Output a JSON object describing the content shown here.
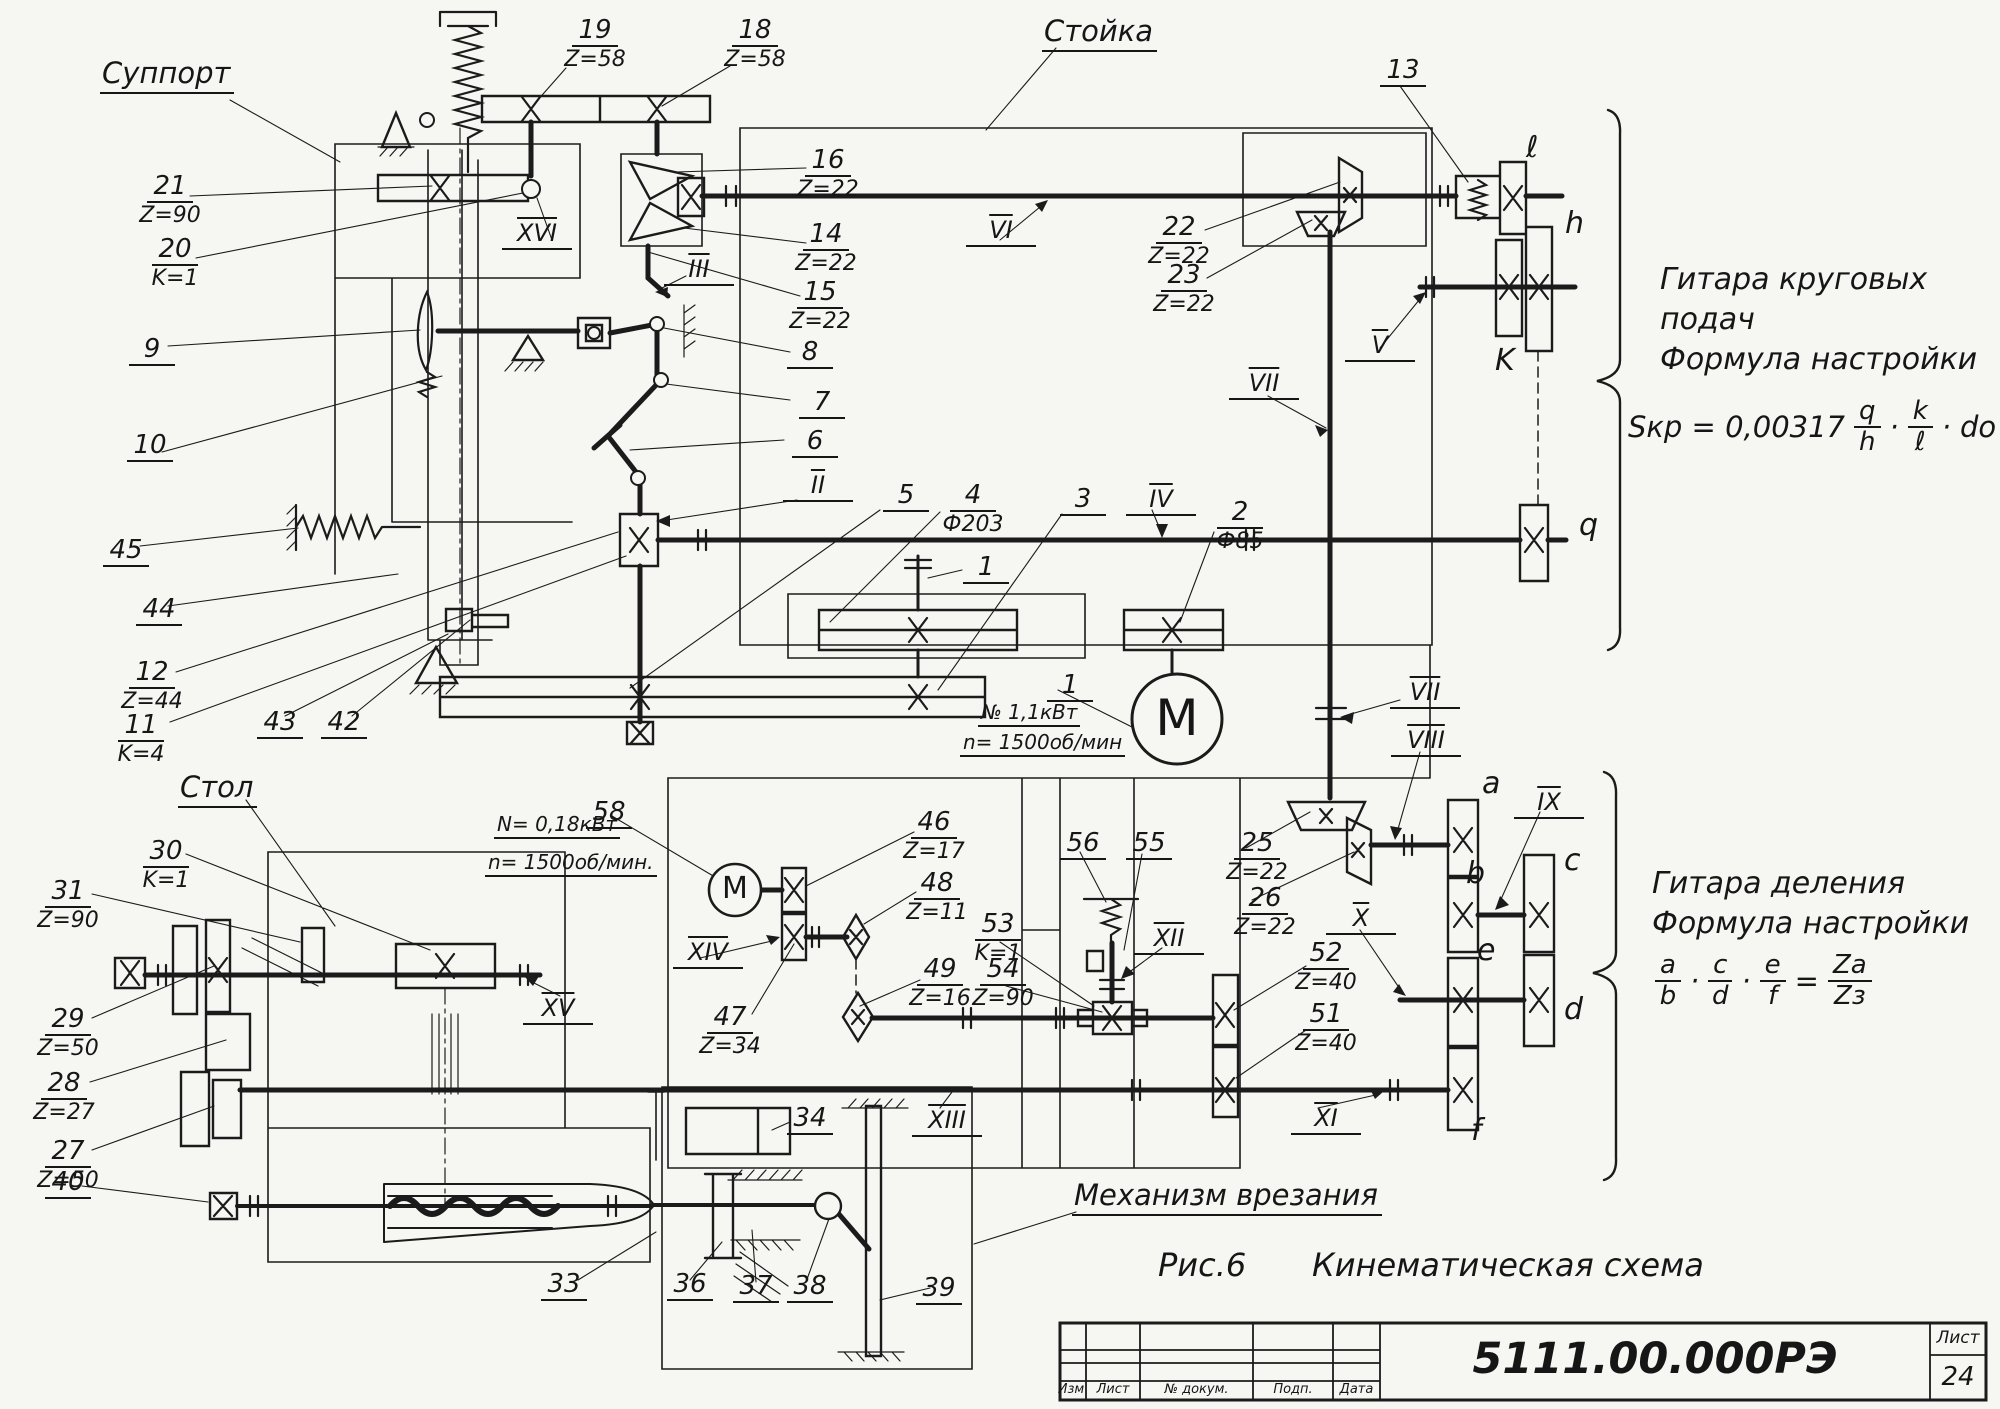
{
  "page": {
    "figure_label": "Рис.6",
    "figure_title": "Кинематическая схема"
  },
  "titles": {
    "support": "Суппорт",
    "stand": "Стойка",
    "table": "Стол",
    "mechanism": "Механизм врезания"
  },
  "notes": {
    "circular": {
      "line1": "Гитара круговых",
      "line2": "подач",
      "line3": "Формула настройки"
    },
    "circular_formula": {
      "lead": "Sкр = 0,00317",
      "n1": "q",
      "d1": "h",
      "dot1": "·",
      "n2": "k",
      "d2": "ℓ",
      "dot2": "·",
      "tail": "do"
    },
    "division": {
      "line1": "Гитара деления",
      "line2": "Формула настройки"
    },
    "division_formula": {
      "n1": "a",
      "d1": "b",
      "dot1": "·",
      "n2": "c",
      "d2": "d",
      "dot2": "·",
      "n3": "e",
      "d3": "f",
      "eq": "=",
      "rn": "Za",
      "rd": "Zз"
    }
  },
  "motors": {
    "main": {
      "symbol": "М",
      "power": "№ 1,1кВт",
      "speed": "n= 1500об/мин"
    },
    "aux": {
      "symbol": "М",
      "power": "N= 0,18кВт",
      "speed": "n= 1500об/мин."
    }
  },
  "callouts": {
    "c1a": {
      "num": "1"
    },
    "c1b": {
      "num": "1"
    },
    "c2": {
      "num": "2",
      "val": "Ф85"
    },
    "c3": {
      "num": "3"
    },
    "c4": {
      "num": "4",
      "val": "Ф203"
    },
    "c5": {
      "num": "5"
    },
    "c6": {
      "num": "6"
    },
    "c7": {
      "num": "7"
    },
    "c8": {
      "num": "8"
    },
    "c9": {
      "num": "9"
    },
    "c10": {
      "num": "10"
    },
    "c11": {
      "num": "11",
      "val": "K=4"
    },
    "c12": {
      "num": "12",
      "val": "Z=44"
    },
    "c13": {
      "num": "13"
    },
    "c14": {
      "num": "14",
      "val": "Z=22"
    },
    "c15": {
      "num": "15",
      "val": "Z=22"
    },
    "c16": {
      "num": "16",
      "val": "Z=22"
    },
    "c18": {
      "num": "18",
      "val": "Z=58"
    },
    "c19": {
      "num": "19",
      "val": "Z=58"
    },
    "c20": {
      "num": "20",
      "val": "K=1"
    },
    "c21": {
      "num": "21",
      "val": "Z=90"
    },
    "c22": {
      "num": "22",
      "val": "Z=22"
    },
    "c23": {
      "num": "23",
      "val": "Z=22"
    },
    "c25": {
      "num": "25",
      "val": "Z=22"
    },
    "c26": {
      "num": "26",
      "val": "Z=22"
    },
    "c27": {
      "num": "27",
      "val": "Z=50"
    },
    "c28": {
      "num": "28",
      "val": "Z=27"
    },
    "c29": {
      "num": "29",
      "val": "Z=50"
    },
    "c30": {
      "num": "30",
      "val": "K=1"
    },
    "c31": {
      "num": "31",
      "val": "Z=90"
    },
    "c33": {
      "num": "33"
    },
    "c34": {
      "num": "34"
    },
    "c36": {
      "num": "36"
    },
    "c37": {
      "num": "37"
    },
    "c38": {
      "num": "38"
    },
    "c39": {
      "num": "39"
    },
    "c40": {
      "num": "40"
    },
    "c42": {
      "num": "42"
    },
    "c43": {
      "num": "43"
    },
    "c44": {
      "num": "44"
    },
    "c45": {
      "num": "45"
    },
    "c46": {
      "num": "46",
      "val": "Z=17"
    },
    "c47": {
      "num": "47",
      "val": "Z=34"
    },
    "c48": {
      "num": "48",
      "val": "Z=11"
    },
    "c49": {
      "num": "49",
      "val": "Z=16"
    },
    "c51": {
      "num": "51",
      "val": "Z=40"
    },
    "c52": {
      "num": "52",
      "val": "Z=40"
    },
    "c53": {
      "num": "53",
      "val": "K=1"
    },
    "c54": {
      "num": "54",
      "val": "Z=90"
    },
    "c55": {
      "num": "55"
    },
    "c56": {
      "num": "56"
    },
    "c58": {
      "num": "58"
    }
  },
  "shafts": {
    "s2": "II",
    "s3": "III",
    "s4": "IV",
    "s5": "V",
    "s6": "VI",
    "s7a": "VII",
    "s7b": "VII",
    "s8": "VIII",
    "s9": "IX",
    "s10": "X",
    "s11": "XI",
    "s12": "XII",
    "s13": "XIII",
    "s14": "XIV",
    "s15": "XV",
    "s16": "XVI"
  },
  "letters": {
    "l": "ℓ",
    "h": "h",
    "k": "K",
    "q": "q",
    "a": "a",
    "b": "b",
    "c": "c",
    "d": "d",
    "e": "e",
    "f": "f"
  },
  "title_block": {
    "doc_number": "5111.00.000РЭ",
    "sheet_label": "Лист",
    "sheet_number": "24",
    "columns": [
      "Изм",
      "Лист",
      "№ докум.",
      "Подп.",
      "Дата"
    ]
  }
}
